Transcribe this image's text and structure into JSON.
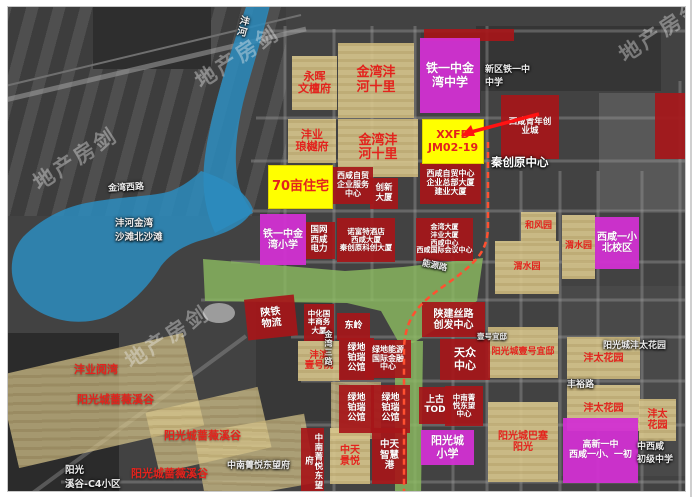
{
  "watermark": {
    "text": "地产房剑",
    "positions": [
      {
        "x": 26,
        "y": 142
      },
      {
        "x": 188,
        "y": 40
      },
      {
        "x": 118,
        "y": 320
      },
      {
        "x": 612,
        "y": 14
      }
    ]
  },
  "colors": {
    "water": "#2b8cbe",
    "park": "#8cbb60",
    "tan": "rgba(216,199,141,0.9)",
    "redbox": "rgba(166,22,25,0.92)",
    "magenta": "rgba(210,48,210,0.95)",
    "yellow": "#ffff00",
    "redtext": "#e3231d",
    "dashed": "#ff5030",
    "arrow": "#ff1212"
  },
  "map": {
    "parcels": [
      {
        "id": "yonghui-wentanfu",
        "lines": [
          "永晖",
          "文檀府"
        ],
        "x": 291,
        "y": 55,
        "w": 45,
        "h": 54,
        "fs": 11
      },
      {
        "id": "jinwan-fenghe-shili-north",
        "lines": [
          "金湾沣",
          "河十里"
        ],
        "x": 337,
        "y": 42,
        "w": 76,
        "h": 75,
        "fs": 13
      },
      {
        "id": "fengye-langyuefu",
        "lines": [
          "沣业",
          "琅樾府"
        ],
        "x": 287,
        "y": 118,
        "w": 48,
        "h": 44,
        "fs": 11
      },
      {
        "id": "jinwan-fenghe-shili-south",
        "lines": [
          "金湾沣",
          "河十里"
        ],
        "x": 337,
        "y": 118,
        "w": 80,
        "h": 58,
        "fs": 13
      },
      {
        "id": "hefengyuan",
        "lines": [
          "和风园"
        ],
        "x": 520,
        "y": 211,
        "w": 35,
        "h": 29,
        "fs": 9
      },
      {
        "id": "weishuiyuan-west",
        "lines": [
          "渭水园"
        ],
        "x": 494,
        "y": 240,
        "w": 64,
        "h": 53,
        "fs": 9
      },
      {
        "id": "weishuiyuan-east",
        "lines": [
          "渭水园"
        ],
        "x": 561,
        "y": 214,
        "w": 33,
        "h": 64,
        "fs": 9
      },
      {
        "id": "fengbin-yihaoyuan",
        "lines": [
          "沣滨",
          "壹号院"
        ],
        "x": 297,
        "y": 340,
        "w": 42,
        "h": 40,
        "fs": 9.5
      },
      {
        "id": "yangguangcheng-yihao-yidi",
        "lines": [
          "阳光城壹号宜邸"
        ],
        "x": 487,
        "y": 326,
        "w": 70,
        "h": 51,
        "fs": 9
      },
      {
        "id": "fengtai-huayuan-1",
        "lines": [
          "沣太花园"
        ],
        "x": 566,
        "y": 336,
        "w": 73,
        "h": 42,
        "fs": 10
      },
      {
        "id": "fengtai-huayuan-2",
        "lines": [
          "沣太花园"
        ],
        "x": 566,
        "y": 384,
        "w": 73,
        "h": 46,
        "fs": 10
      },
      {
        "id": "fengtai-huayuan-3",
        "lines": [
          "沣太",
          "花园"
        ],
        "x": 638,
        "y": 398,
        "w": 37,
        "h": 42,
        "fs": 10
      },
      {
        "id": "yangguangcheng-basai-yangguang",
        "lines": [
          "阳光城巴塞",
          "阳光"
        ],
        "x": 487,
        "y": 401,
        "w": 70,
        "h": 80,
        "fs": 10
      },
      {
        "id": "zhongtian-jingyue",
        "lines": [
          "中天",
          "景悦"
        ],
        "x": 329,
        "y": 427,
        "w": 40,
        "h": 56,
        "fs": 10
      }
    ],
    "areas": [
      {
        "id": "qiangwei-xigu-area-1",
        "x": 5,
        "y": 352,
        "w": 190,
        "h": 95,
        "rot": -13
      },
      {
        "id": "qiangwei-xigu-area-2",
        "x": 150,
        "y": 398,
        "w": 115,
        "h": 62,
        "rot": -13
      },
      {
        "id": "qiangwei-xigu-area-3",
        "x": 198,
        "y": 422,
        "w": 112,
        "h": 70,
        "rot": -10
      },
      {
        "id": "boru-back-area",
        "x": 330,
        "y": 381,
        "w": 50,
        "h": 57,
        "rot": 0
      }
    ],
    "buildings": [
      {
        "id": "zimao-qiye-fuwu-zhongxin",
        "lines": [
          "西咸自贸",
          "企业服务",
          "中心"
        ],
        "x": 332,
        "y": 166,
        "w": 40,
        "h": 37,
        "fs": 8
      },
      {
        "id": "chuangxin-dasha",
        "lines": [
          "创新",
          "大厦"
        ],
        "x": 369,
        "y": 177,
        "w": 28,
        "h": 31,
        "fs": 8.5
      },
      {
        "id": "zimao-zhongxin-zongbu",
        "lines": [
          "西咸自贸中心",
          "企业总部大厦",
          "建业大厦"
        ],
        "x": 419,
        "y": 162,
        "w": 61,
        "h": 41,
        "fs": 8
      },
      {
        "id": "xixian-qingnian-chuangyecheng",
        "lines": [
          "西咸青年创",
          "业城"
        ],
        "x": 500,
        "y": 94,
        "w": 58,
        "h": 64,
        "fs": 8.5
      },
      {
        "id": "guowang-xixian-dianli",
        "lines": [
          "国网",
          "西咸",
          "电力"
        ],
        "x": 302,
        "y": 221,
        "w": 32,
        "h": 37,
        "fs": 8.5
      },
      {
        "id": "nuofute-xixian-dasha",
        "lines": [
          "诺富特酒店",
          "西咸大厦",
          "秦创原科创大厦"
        ],
        "x": 336,
        "y": 217,
        "w": 58,
        "h": 44,
        "fs": 7.5
      },
      {
        "id": "jinwan-dasha-xixian-zhongxin",
        "lines": [
          "金湾大厦",
          "沣业大厦",
          "西咸中心",
          "西咸国际会议中心"
        ],
        "x": 415,
        "y": 217,
        "w": 57,
        "h": 43,
        "fs": 7
      },
      {
        "id": "shantie-wuliu",
        "lines": [
          "陕铁",
          "物流"
        ],
        "x": 245,
        "y": 296,
        "w": 50,
        "h": 41,
        "fs": 10,
        "rot": -6
      },
      {
        "id": "zhonghua-guofeng-shangwu-dasha",
        "lines": [
          "中化国",
          "丰商务",
          "大厦"
        ],
        "x": 303,
        "y": 303,
        "w": 30,
        "h": 37,
        "fs": 7.5
      },
      {
        "id": "dongling",
        "lines": [
          "东岭"
        ],
        "x": 336,
        "y": 312,
        "w": 33,
        "h": 27,
        "fs": 9
      },
      {
        "id": "lvdi-boru-gongguan-1",
        "lines": [
          "绿地",
          "铂瑞",
          "公馆"
        ],
        "x": 338,
        "y": 337,
        "w": 35,
        "h": 42,
        "fs": 9
      },
      {
        "id": "lvdi-nengyuan-guoji-jinrong",
        "lines": [
          "绿地能源",
          "国际金融",
          "中心"
        ],
        "x": 364,
        "y": 339,
        "w": 46,
        "h": 38,
        "fs": 8
      },
      {
        "id": "shanjian-silu-chuangfa-zhongxin",
        "lines": [
          "陕建丝路",
          "创发中心"
        ],
        "x": 421,
        "y": 301,
        "w": 63,
        "h": 35,
        "fs": 10
      },
      {
        "id": "tianzhong-zhongxin",
        "lines": [
          "天众",
          "中心"
        ],
        "x": 439,
        "y": 338,
        "w": 50,
        "h": 41,
        "fs": 11
      },
      {
        "id": "lvdi-boru-gongguan-2",
        "lines": [
          "绿地",
          "铂瑞",
          "公馆"
        ],
        "x": 338,
        "y": 384,
        "w": 35,
        "h": 48,
        "fs": 9
      },
      {
        "id": "lvdi-boru-gongguan-3",
        "lines": [
          "绿地",
          "铂瑞",
          "公馆"
        ],
        "x": 370,
        "y": 384,
        "w": 39,
        "h": 48,
        "fs": 9
      },
      {
        "id": "shanggu-tod",
        "lines": [
          "上古",
          "TOD"
        ],
        "x": 418,
        "y": 386,
        "w": 32,
        "h": 37,
        "fs": 9
      },
      {
        "id": "zhongnan-jingyue-dongwang-zhongxin",
        "lines": [
          "中南菁",
          "悦东望",
          "中心"
        ],
        "x": 444,
        "y": 385,
        "w": 38,
        "h": 40,
        "fs": 7.5
      },
      {
        "id": "zhongnan-jingyue-dongwang-fu",
        "lines": [
          "中南菁悦东望府"
        ],
        "x": 300,
        "y": 427,
        "w": 23,
        "h": 66,
        "fs": 8.5,
        "vert": true
      },
      {
        "id": "zhongtian-zhihui-gang",
        "lines": [
          "中天",
          "智慧",
          "港"
        ],
        "x": 371,
        "y": 427,
        "w": 35,
        "h": 56,
        "fs": 9.5
      },
      {
        "id": "red-strip-top",
        "lines": [],
        "x": 423,
        "y": 28,
        "w": 90,
        "h": 12
      },
      {
        "id": "red-block-right-edge",
        "lines": [],
        "x": 654,
        "y": 92,
        "w": 32,
        "h": 66
      }
    ],
    "schools": [
      {
        "id": "tieyizhong-jinwan-zhongxue",
        "lines": [
          "铁一中金",
          "湾中学"
        ],
        "x": 419,
        "y": 37,
        "w": 60,
        "h": 75,
        "fs": 12
      },
      {
        "id": "tieyizhong-jinwan-xiaoxue",
        "lines": [
          "铁一中金",
          "湾小学"
        ],
        "x": 259,
        "y": 213,
        "w": 46,
        "h": 51,
        "fs": 10
      },
      {
        "id": "xixian-yixiao-beixiaoqu",
        "lines": [
          "西咸一小",
          "北校区"
        ],
        "x": 594,
        "y": 216,
        "w": 44,
        "h": 52,
        "fs": 10
      },
      {
        "id": "yangguangcheng-xiaoxue",
        "lines": [
          "阳光城",
          "小学"
        ],
        "x": 420,
        "y": 429,
        "w": 53,
        "h": 35,
        "fs": 11
      },
      {
        "id": "gaoxin-yizhong-xixian-yixiao",
        "lines": [
          "高新一中",
          "西咸一小、一初"
        ],
        "x": 562,
        "y": 417,
        "w": 75,
        "h": 65,
        "fs": 9
      }
    ],
    "highlights": [
      {
        "id": "70mu-zhuzhai",
        "lines": [
          "70亩住宅"
        ],
        "x": 267,
        "y": 164,
        "w": 65,
        "h": 44,
        "fs": 13
      },
      {
        "id": "xxfd-jm02-19",
        "lines": [
          "XXFD",
          "JM02-19"
        ],
        "x": 421,
        "y": 118,
        "w": 62,
        "h": 45,
        "fs": 11
      }
    ],
    "red_labels": [
      {
        "id": "fengye-yuewan",
        "text": "沣业阅湾",
        "x": 73,
        "y": 360,
        "fs": 11
      },
      {
        "id": "qiangwei-xigu-1",
        "text": "阳光城蔷薇溪谷",
        "x": 76,
        "y": 390,
        "fs": 11
      },
      {
        "id": "qiangwei-xigu-2",
        "text": "阳光城蔷薇溪谷",
        "x": 163,
        "y": 426,
        "fs": 11
      },
      {
        "id": "qiangwei-xigu-3",
        "text": "阳光城蔷薇溪谷",
        "x": 130,
        "y": 464,
        "fs": 11
      }
    ],
    "bg_labels": [
      {
        "id": "bg-xinqu-tieyizhong",
        "lines": [
          "新区铁一中",
          "中学"
        ],
        "x": 484,
        "y": 61,
        "fs": 9
      },
      {
        "id": "bg-qinchuangyuan-zhongxin",
        "lines": [
          "秦创原中心"
        ],
        "x": 490,
        "y": 153,
        "fs": 11.5,
        "big": true
      },
      {
        "id": "bg-fenghe-jinwan-shatan",
        "lines": [
          "沣河金湾",
          "沙滩北沙滩"
        ],
        "x": 114,
        "y": 214,
        "fs": 9.5
      },
      {
        "id": "bg-yihao-yidi",
        "lines": [
          "壹号宜邸"
        ],
        "x": 476,
        "y": 330,
        "fs": 7.5
      },
      {
        "id": "bg-yangguangcheng-fengtai-huayuan",
        "lines": [
          "阳光城沣太花园"
        ],
        "x": 602,
        "y": 337,
        "fs": 9
      },
      {
        "id": "bg-zhongnan-jingyue-dongwangfu",
        "lines": [
          "中南菁悦东望府"
        ],
        "x": 226,
        "y": 457,
        "fs": 9
      },
      {
        "id": "bg-xigu-c4-xiaoqu",
        "lines": [
          "阳光",
          "溪谷-C4小区"
        ],
        "x": 64,
        "y": 461,
        "fs": 9.5
      },
      {
        "id": "bg-chuji-zhongxue",
        "lines": [
          "中西咸",
          "初级中学"
        ],
        "x": 636,
        "y": 438,
        "fs": 9
      },
      {
        "id": "road-jinwan-xilu",
        "lines": [
          "金湾西路"
        ],
        "x": 107,
        "y": 179,
        "fs": 9,
        "rot": -3
      },
      {
        "id": "road-jinwan-sanlu",
        "lines": [
          "金湾三路"
        ],
        "x": 322,
        "y": 329,
        "fs": 8,
        "vert": true
      },
      {
        "id": "road-nengyuan-lu",
        "lines": [
          "能源路"
        ],
        "x": 421,
        "y": 258,
        "fs": 8.5,
        "rot": 12
      },
      {
        "id": "road-fengyu-lu",
        "lines": [
          "丰裕路"
        ],
        "x": 566,
        "y": 376,
        "fs": 9
      },
      {
        "id": "river-fenghe",
        "lines": [
          "沣河"
        ],
        "x": 233,
        "y": 14,
        "fs": 10,
        "vert": true,
        "rot": 14
      }
    ]
  }
}
